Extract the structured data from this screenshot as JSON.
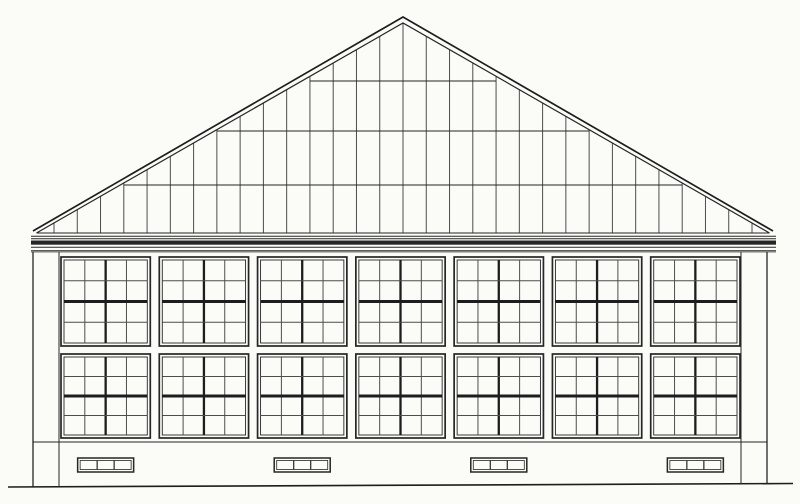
{
  "document": {
    "kind": "architectural-elevation-line-drawing",
    "subject": "gable-end elevation of glazed workshop hall",
    "visible_text": []
  },
  "palette": {
    "paper": "#fbfbf8",
    "ink": "#262626",
    "ink_heavy": "#1d1d1d",
    "ink_light": "#4d4d4d"
  },
  "canvas": {
    "width": 800,
    "height": 504
  },
  "roof": {
    "apex": {
      "x": 403,
      "y": 17
    },
    "inner_apex_y": 23,
    "eave_outer_left": {
      "x": 33,
      "y": 231
    },
    "eave_outer_right": {
      "x": 773,
      "y": 231
    },
    "inner_eave_y": 233,
    "inner_eave_left_x": 36.5,
    "inner_eave_right_x": 769.5,
    "glazing_bar_count": 31,
    "glazing_bar_x_start": 54,
    "glazing_bar_x_end": 752,
    "glazing_bar_bottom_y": 233,
    "rail_lines_y": [
      81,
      131,
      185
    ]
  },
  "cornice": {
    "x": 31,
    "x_end": 776,
    "top_line_y": 233,
    "thin_lines_y": [
      236.3,
      238.8
    ],
    "band": {
      "y": 240.5,
      "height": 4.2
    },
    "lower_lines_y": [
      247.2,
      250.8
    ],
    "bottom_y": 252
  },
  "wall": {
    "left_x": 33,
    "right_x": 767,
    "top_y": 252,
    "pilaster_left_inner_x": 59,
    "pilaster_right_inner_x": 741,
    "plinth_line_y": 442
  },
  "ground": {
    "x_start": 8,
    "y_start": 487,
    "x_end": 793,
    "y_end": 483.5
  },
  "windows": {
    "bays": 7,
    "field_x": 61,
    "field_width": 679,
    "pier_width": 9,
    "rows": [
      {
        "y": 257,
        "height": 89
      },
      {
        "y": 354,
        "height": 84
      }
    ],
    "pane_cols": 4,
    "pane_rows": 4,
    "frame_inset": 3
  },
  "vents": {
    "count": 4,
    "under_bays": [
      0,
      2,
      4,
      6
    ],
    "width": 56,
    "height": 14,
    "y": 458,
    "cells": 3,
    "frame_inset": 2.5
  }
}
